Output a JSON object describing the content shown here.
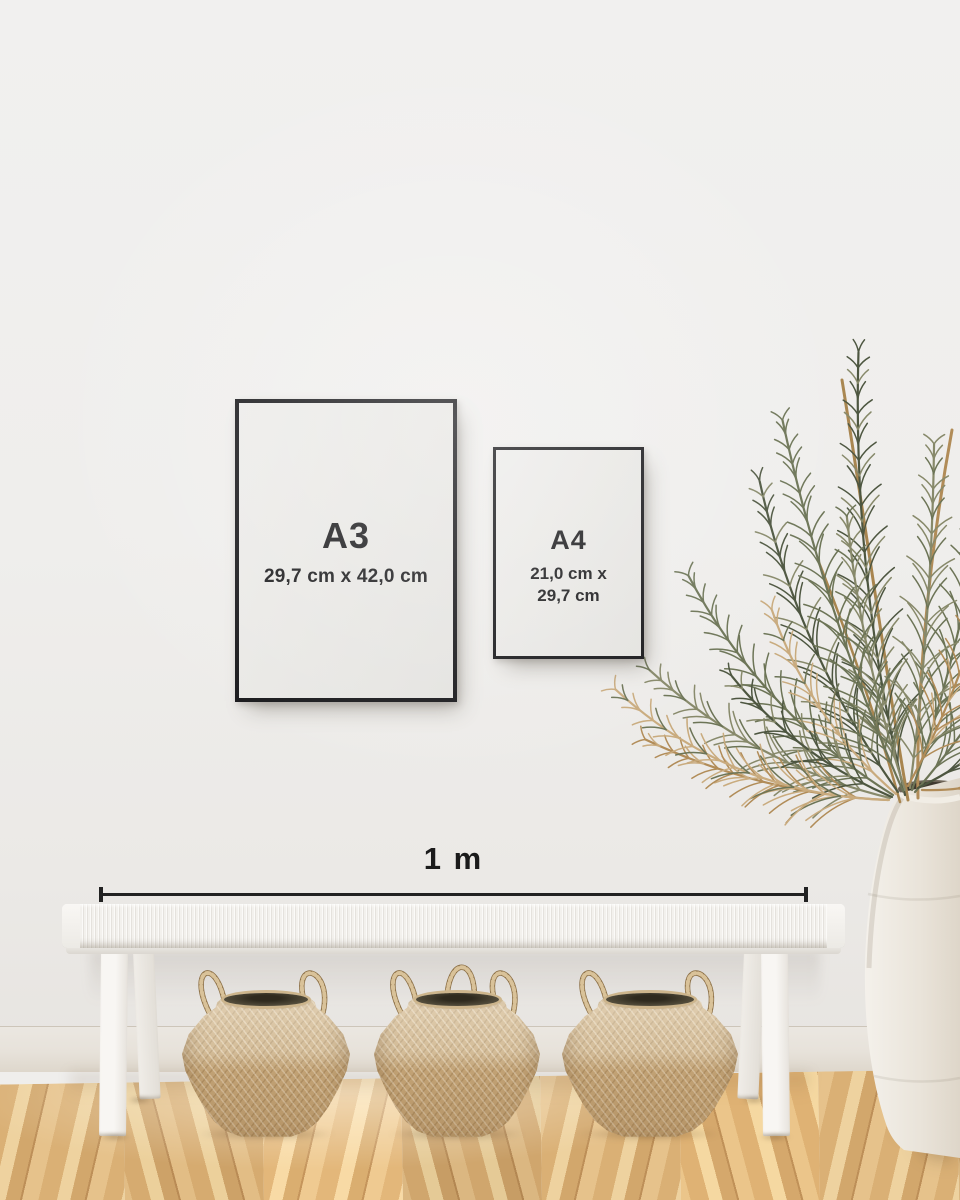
{
  "frames": {
    "a3": {
      "label": "A3",
      "dimensions": "29,7 cm x 42,0 cm"
    },
    "a4": {
      "label": "A4",
      "dimensions_line1": "21,0 cm x",
      "dimensions_line2": "29,7 cm"
    }
  },
  "measurement": {
    "label": "1 m"
  },
  "colors": {
    "wall": "#efeeec",
    "baseboard": "#e7e2da",
    "floor_oak": "#ddb37c",
    "frame_border": "#17171a",
    "frame_paper": "#eae9e6",
    "text_dark": "#1c1c1e",
    "ruler": "#222222",
    "bench_white": "#f4f2ee",
    "basket_tan": "#c6a87c",
    "basket_rope_dark": "#8d7148",
    "basket_rope_light": "#d9c299",
    "vase_white": "#ece7de",
    "plant_green": "#6c7456",
    "plant_green_dark": "#4d5640",
    "plant_green_light": "#87896a",
    "plant_tan": "#b18c58",
    "plant_tan_light": "#c9ab7e",
    "stem_tan": "#a8854f"
  }
}
